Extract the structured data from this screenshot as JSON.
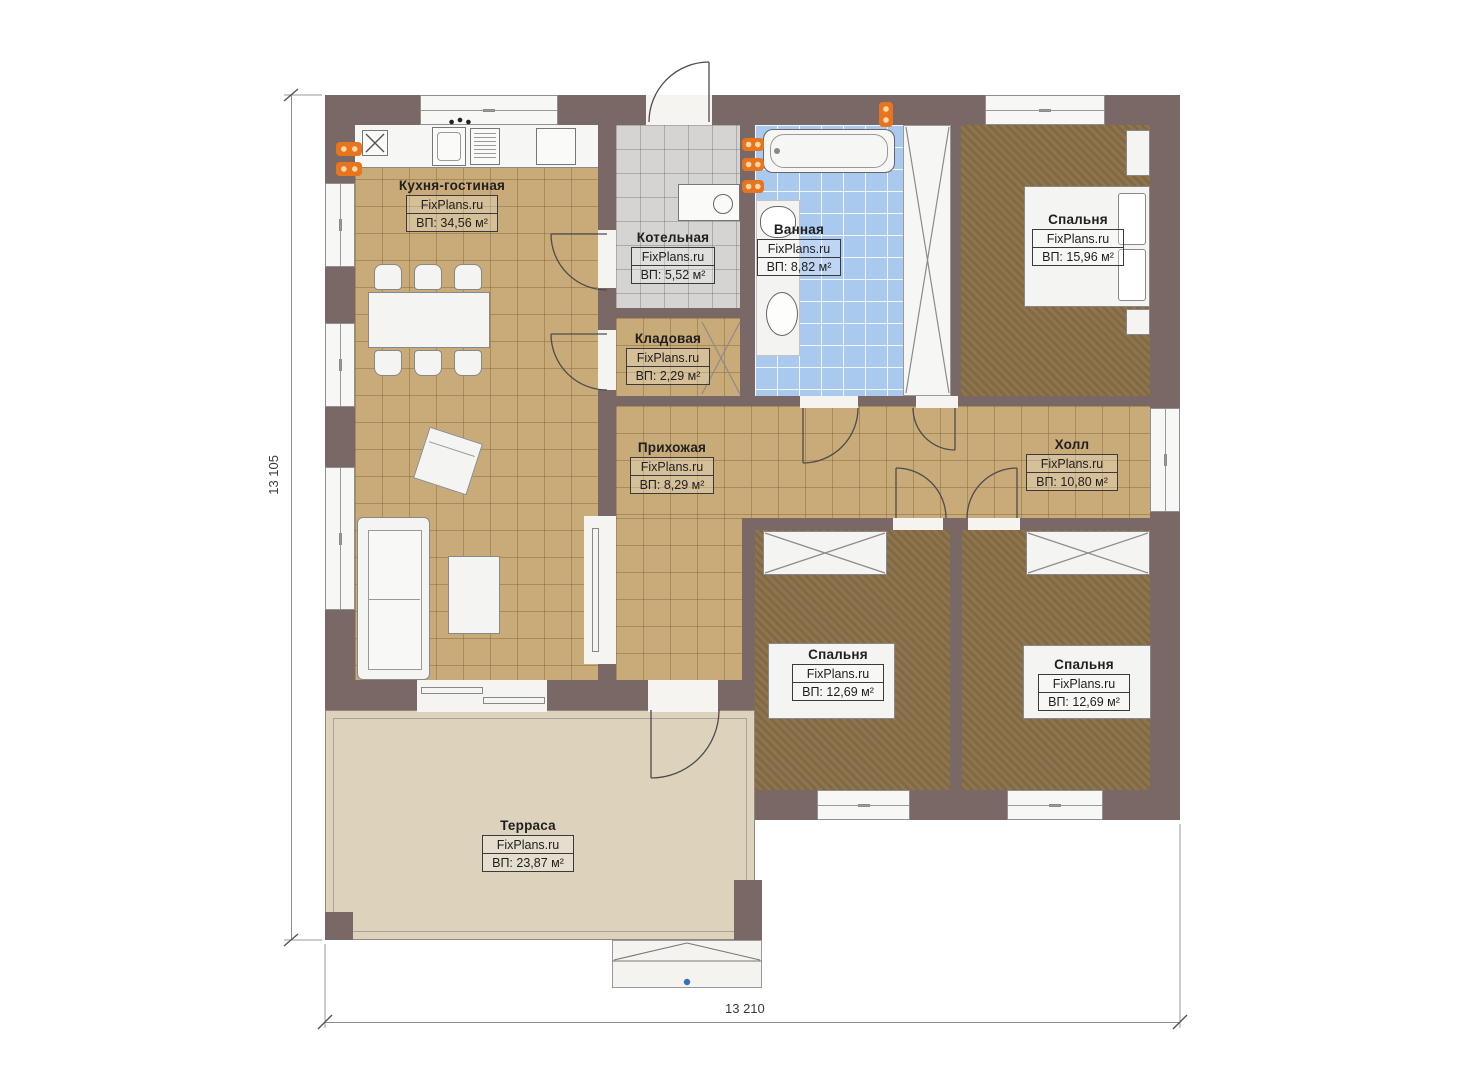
{
  "plan": {
    "brand": "FixPlans.ru",
    "rooms": [
      {
        "key": "kitchen-living",
        "name": "Кухня-гостиная",
        "area": "ВП: 34,56 м²"
      },
      {
        "key": "boiler-room",
        "name": "Котельная",
        "area": "ВП: 5,52 м²"
      },
      {
        "key": "pantry",
        "name": "Кладовая",
        "area": "ВП: 2,29 м²"
      },
      {
        "key": "bathroom",
        "name": "Ванная",
        "area": "ВП: 8,82 м²"
      },
      {
        "key": "bedroom-top-right",
        "name": "Спальня",
        "area": "ВП: 15,96 м²"
      },
      {
        "key": "entry-hall",
        "name": "Прихожая",
        "area": "ВП: 8,29 м²"
      },
      {
        "key": "hall",
        "name": "Холл",
        "area": "ВП: 10,80 м²"
      },
      {
        "key": "bedroom-bottom-middle",
        "name": "Спальня",
        "area": "ВП: 12,69 м²"
      },
      {
        "key": "bedroom-bottom-right",
        "name": "Спальня",
        "area": "ВП: 12,69 м²"
      },
      {
        "key": "terrace",
        "name": "Терраса",
        "area": "ВП: 23,87 м²"
      }
    ],
    "dimensions": {
      "vertical": "13 105",
      "horizontal": "13 210"
    },
    "colors": {
      "wall": "#7a6867",
      "floor_tile_tan": "#c9ab79",
      "floor_wood_brown": "#8b7149",
      "floor_tile_blue": "#a9c9ef",
      "floor_tile_gray": "#d5d4d2",
      "terrace_floor": "#ddd2bc",
      "radiator_orange": "#e8751e",
      "stairs_marker_blue": "#3c6eb5"
    },
    "icons": {
      "fixtures": [
        "bathtub-icon",
        "bathroom-sink-icon",
        "toilet-icon",
        "kitchen-sink-icon",
        "dishwasher-icon",
        "stove-icon",
        "vent-icon",
        "boiler-unit-icon",
        "radiator-icon",
        "sofa-icon",
        "armchair-icon",
        "coffee-table-icon",
        "dining-table-icon",
        "chair-icon",
        "bed-icon",
        "pillow-icon",
        "nightstand-icon",
        "dresser-icon",
        "wardrobe-icon",
        "closet-shaft-icon",
        "sliding-door-icon",
        "door-swing-icon",
        "entry-stairs-icon"
      ]
    }
  }
}
